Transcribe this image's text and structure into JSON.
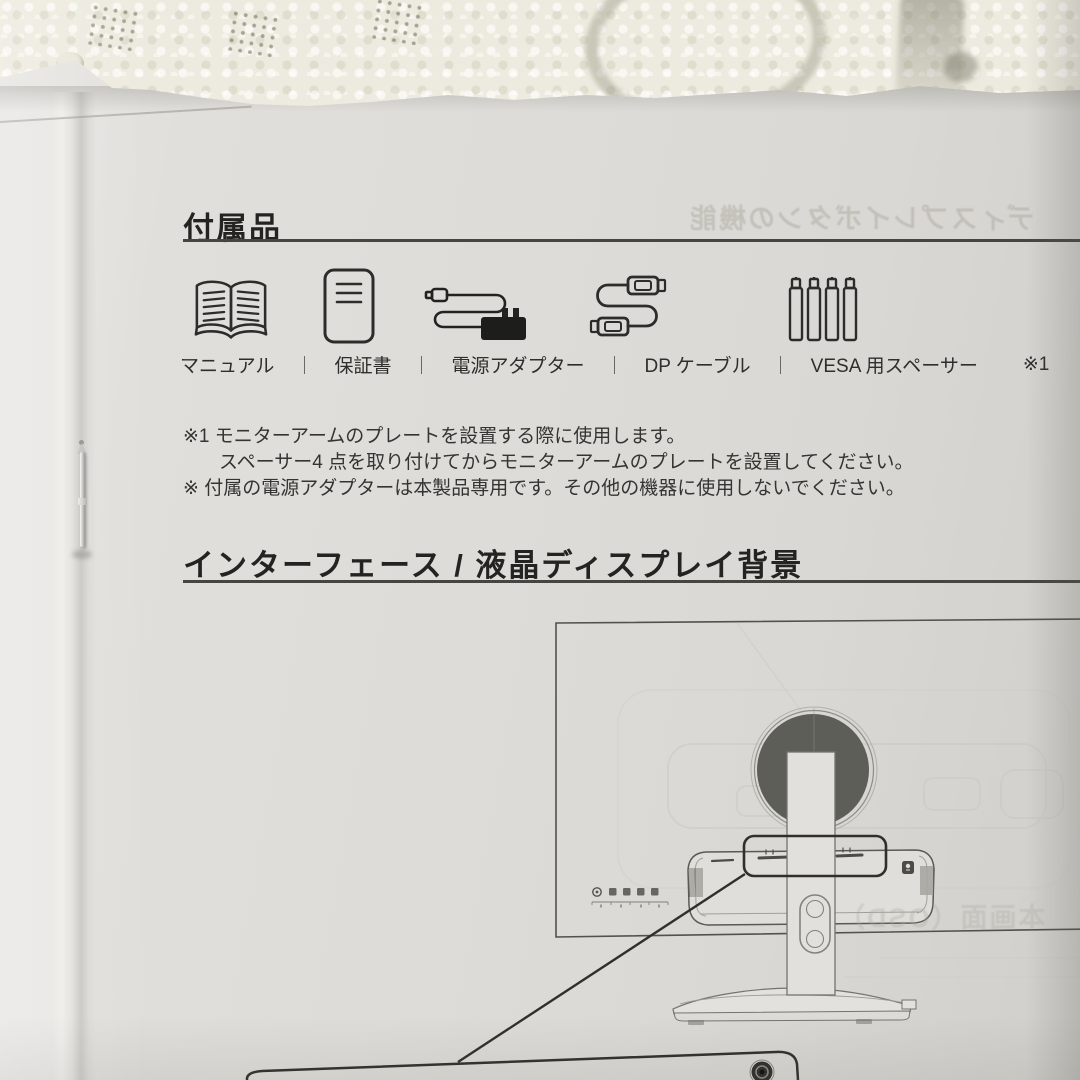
{
  "page": {
    "accessories": {
      "title": "付属品",
      "separator": "｜",
      "footnote_marker": "※1",
      "items": [
        {
          "icon": "book-icon",
          "label": "マニュアル"
        },
        {
          "icon": "warranty-card-icon",
          "label": "保証書"
        },
        {
          "icon": "power-adapter-icon",
          "label": "電源アダプター"
        },
        {
          "icon": "dp-cable-icon",
          "label": "DP ケーブル"
        },
        {
          "icon": "vesa-spacer-icon",
          "label": "VESA 用スペーサー"
        }
      ],
      "notes": [
        "※1 モニターアームのプレートを設置する際に使用します。",
        "スペーサー4 点を取り付けてからモニターアームのプレートを設置してください。",
        "※ 付属の電源アダプターは本製品専用です。その他の機器に使用しないでください。"
      ]
    },
    "interface_section": {
      "title": "インターフェース / 液晶ディスプレイ背景"
    },
    "ghost_text": {
      "top_right": "ディスプレイボタンの機能",
      "bottom_right": "本画面（OSD）"
    },
    "diagram": {
      "subject": "monitor-rear-view",
      "callout_target": "rear-ports-recess"
    },
    "colors": {
      "paper": "#dedcd8",
      "ink": "#2b2b29",
      "line_art": "#52524d",
      "vesa_circle": "#5e5e59",
      "foam": "#edebdf"
    }
  }
}
